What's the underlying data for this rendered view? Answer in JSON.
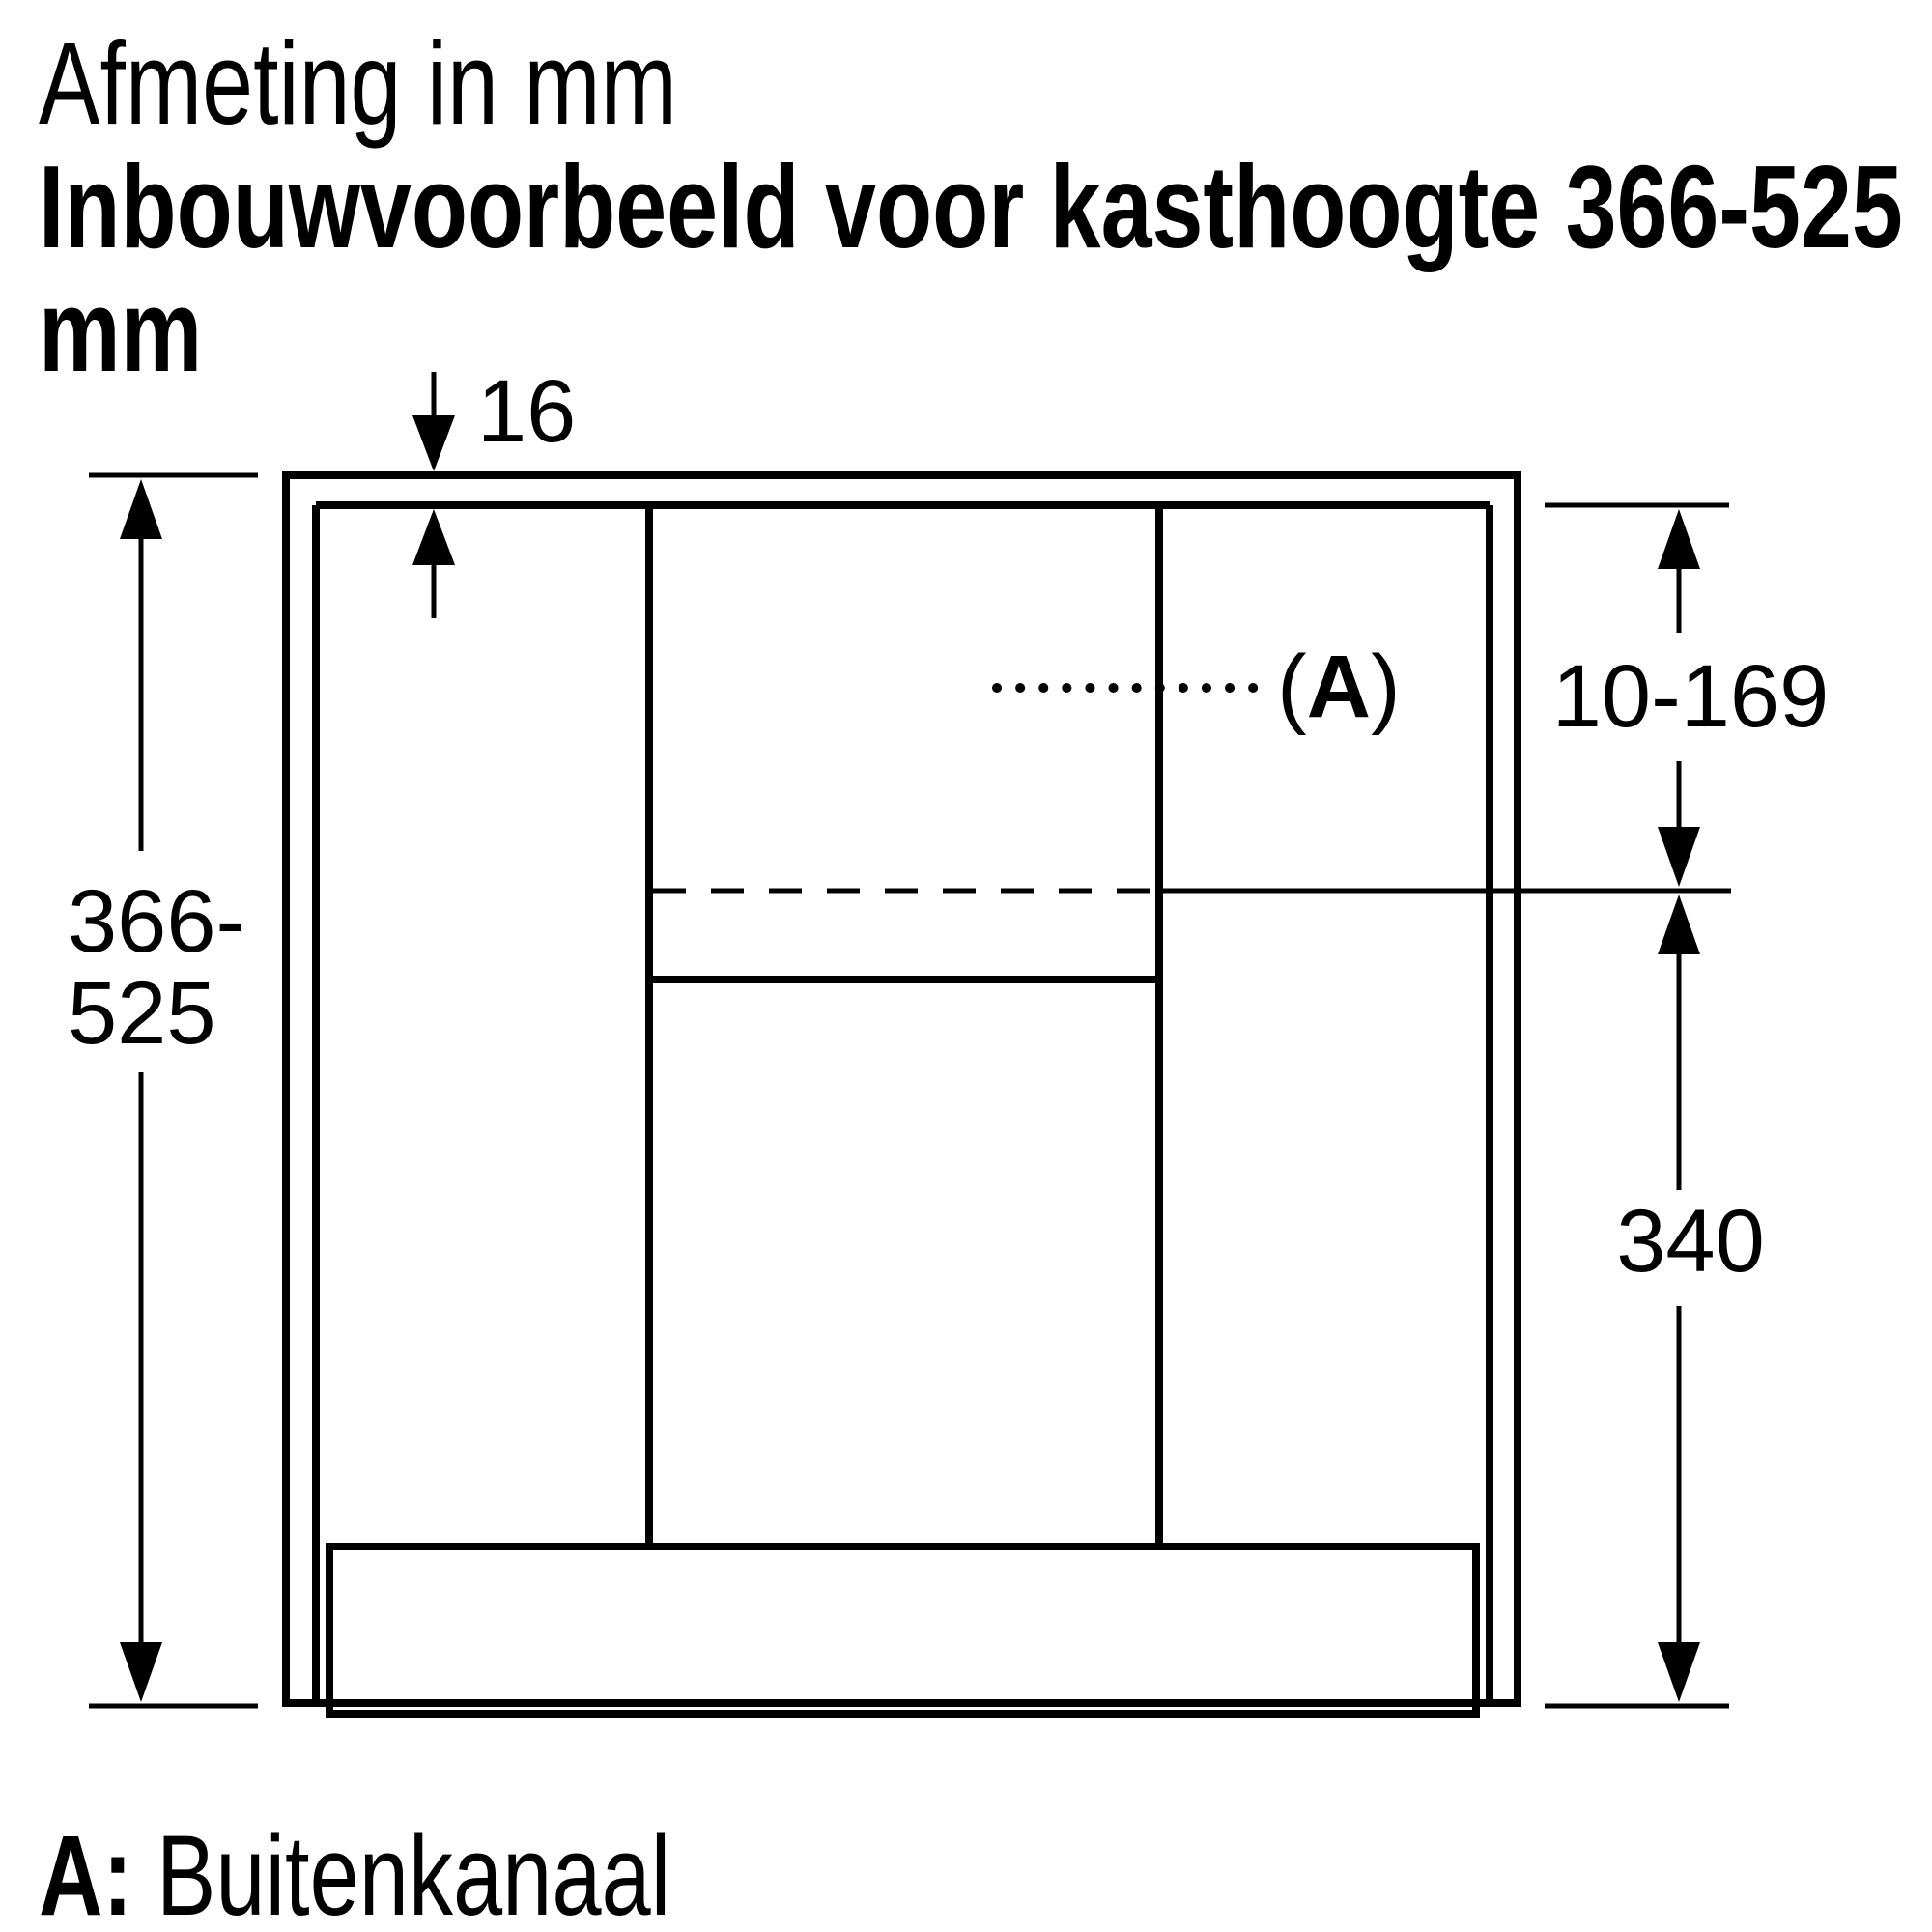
{
  "title": {
    "line1": "Afmeting in mm",
    "line2": "Inbouwvoorbeeld voor kasthoogte 366-525",
    "line3": "mm"
  },
  "dimensions": {
    "panel_thickness": "16",
    "cabinet_height_line1": "366-",
    "cabinet_height_line2": "525",
    "duct_clearance": "10-169",
    "hood_height": "340"
  },
  "callout": {
    "open": "(",
    "letter": "A",
    "close": ")"
  },
  "legend": {
    "key": "A:",
    "label": "Buitenkanaal"
  },
  "colors": {
    "line": "#000000",
    "shaded_fill": "#d0d0d0",
    "background": "#ffffff"
  }
}
